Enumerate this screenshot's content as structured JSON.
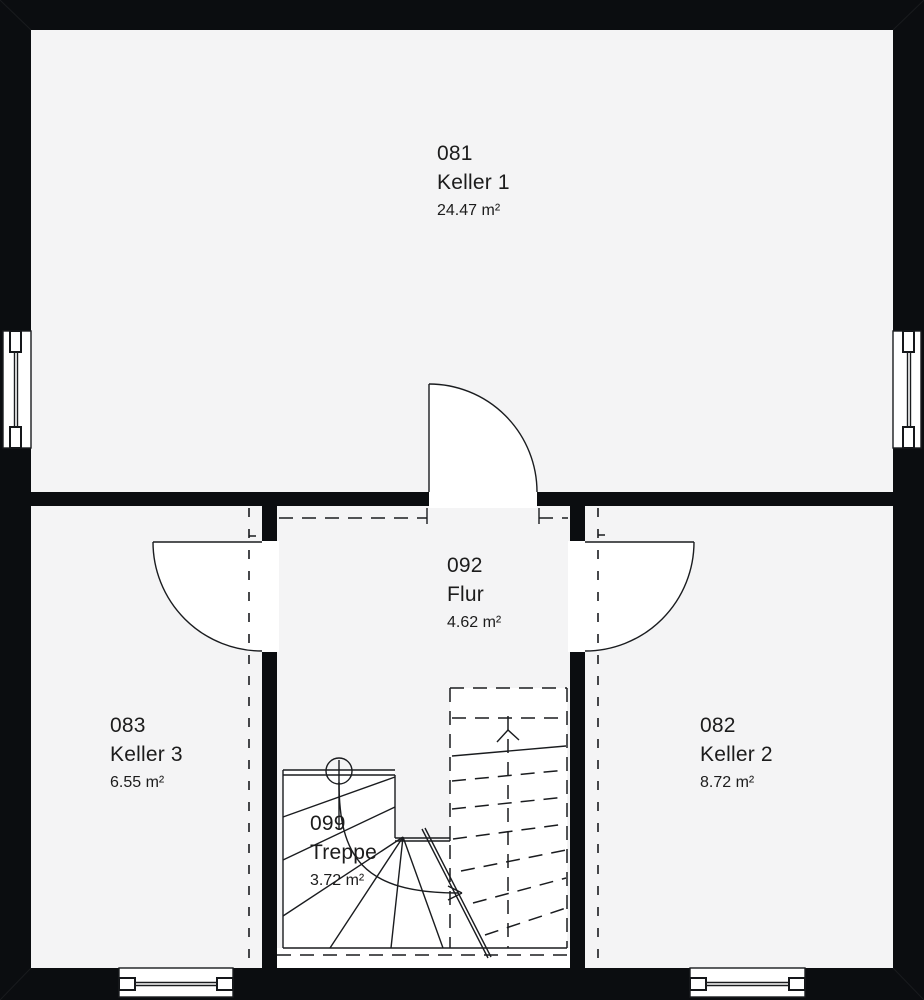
{
  "plan": {
    "rooms": [
      {
        "number": "081",
        "name": "Keller 1",
        "area": "24.47 m²"
      },
      {
        "number": "092",
        "name": "Flur",
        "area": "4.62 m²"
      },
      {
        "number": "083",
        "name": "Keller 3",
        "area": "6.55 m²"
      },
      {
        "number": "082",
        "name": "Keller 2",
        "area": "8.72 m²"
      },
      {
        "number": "099",
        "name": "Treppe",
        "area": "3.72 m²"
      }
    ],
    "colors": {
      "wall": "#0b0d10",
      "floor": "#f4f4f5",
      "open_area": "#ffffff",
      "line": "#1a1c1f"
    }
  }
}
